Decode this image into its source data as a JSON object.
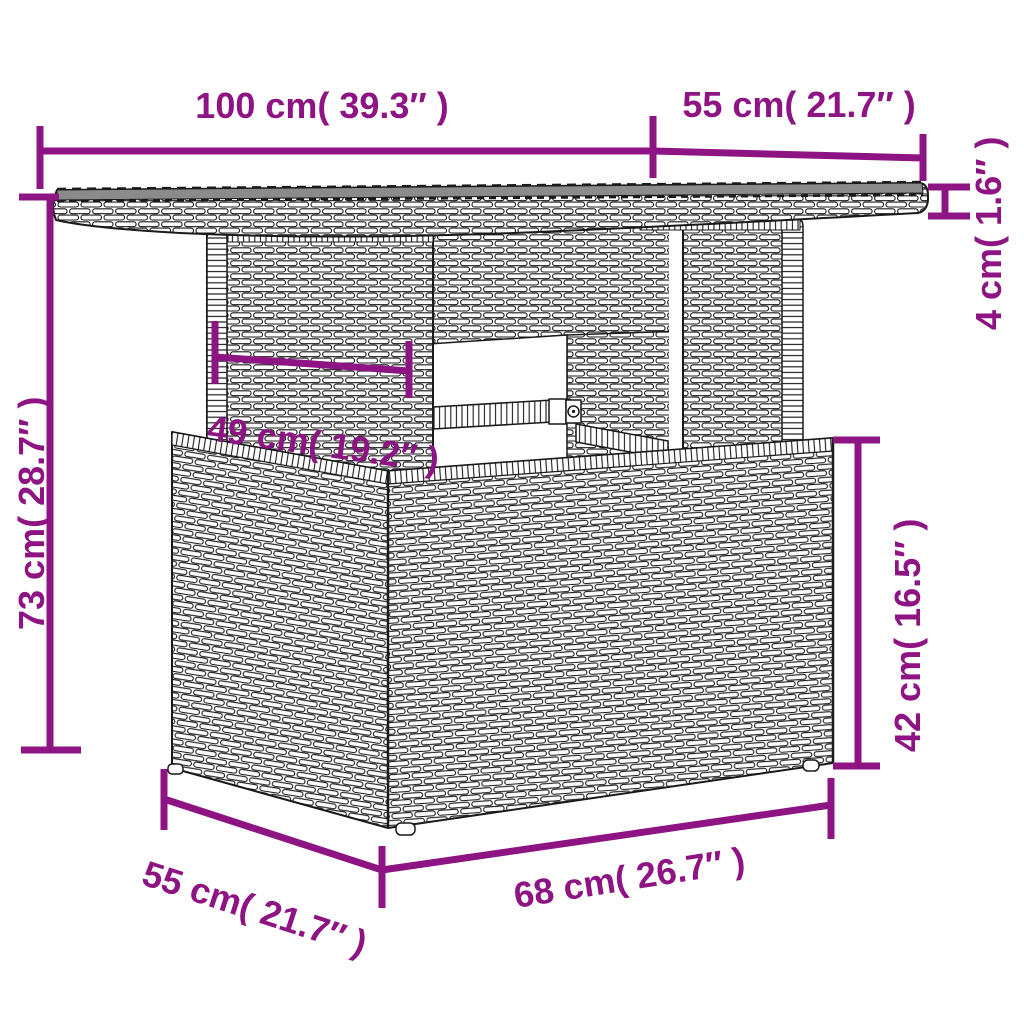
{
  "diagram": {
    "kind": "furniture-dimension-diagram",
    "subject": "poly rattan garden table with glass top and storage base",
    "accent_color": "#8E1483",
    "outline_color": "#1a1a1a",
    "glass_color": "#8B8B8B",
    "background_color": "#ffffff"
  },
  "dims": {
    "tabletop_width": "100 cm( 39.3″ )",
    "tabletop_depth": "55 cm( 21.7″ )",
    "tabletop_thickness": "4 cm( 1.6″ )",
    "leg_panel_width": "49 cm( 19.2″ )",
    "total_height": "73 cm( 28.7″ )",
    "base_height": "42 cm( 16.5″ )",
    "base_depth": "55 cm( 21.7″ )",
    "base_width": "68 cm( 26.7″ )"
  }
}
